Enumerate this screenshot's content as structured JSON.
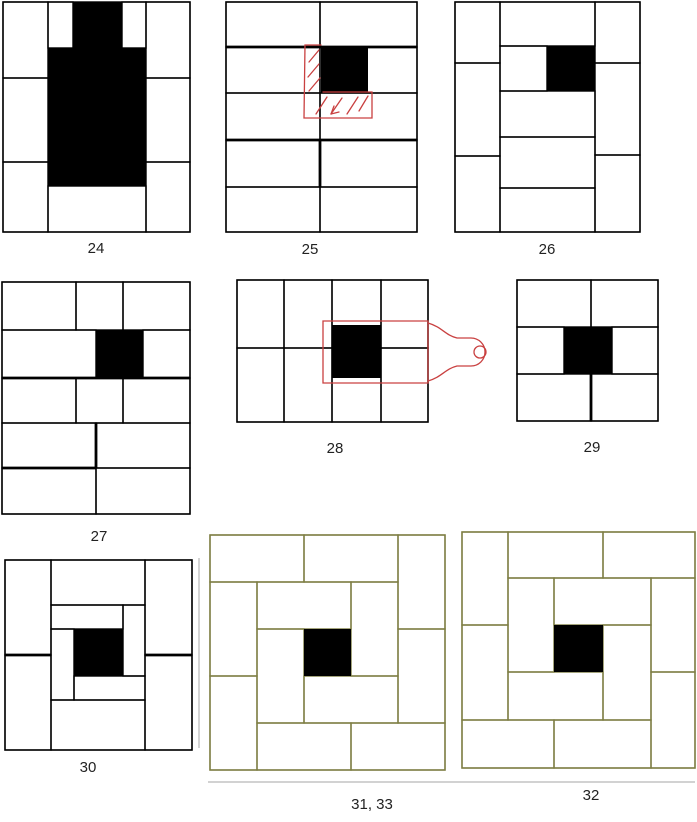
{
  "canvas": {
    "width": 697,
    "height": 822,
    "background": "#ffffff"
  },
  "colors": {
    "line": "#000000",
    "olive": "#7e7e44",
    "red": "#c94040",
    "artifact_gray": "#b8b8b8",
    "black_fill": "#000000",
    "caption_text": "#222222"
  },
  "diagrams": [
    {
      "id": "24",
      "caption": "24",
      "stroke": "#000000",
      "frame": [
        3,
        2,
        187,
        230
      ],
      "cells": [
        [
          3,
          2,
          45,
          76
        ],
        [
          3,
          78,
          45,
          84
        ],
        [
          3,
          162,
          45,
          70
        ],
        [
          146,
          2,
          44,
          76
        ],
        [
          146,
          78,
          44,
          84
        ],
        [
          146,
          162,
          44,
          70
        ],
        [
          48,
          2,
          25,
          46
        ],
        [
          122,
          2,
          24,
          46
        ],
        [
          48,
          186,
          98,
          46
        ]
      ],
      "black": [
        [
          73,
          2,
          49,
          46
        ],
        [
          48,
          48,
          98,
          138
        ]
      ]
    },
    {
      "id": "25",
      "caption": "25",
      "stroke": "#000000",
      "frame": [
        226,
        2,
        191,
        230
      ],
      "cells": [
        [
          226,
          2,
          94,
          45
        ],
        [
          320,
          2,
          97,
          45
        ],
        [
          226,
          47,
          94,
          46
        ],
        [
          320,
          47,
          97,
          46
        ],
        [
          226,
          93,
          94,
          47
        ],
        [
          320,
          93,
          97,
          47
        ],
        [
          226,
          140,
          94,
          47
        ],
        [
          320,
          140,
          97,
          47
        ],
        [
          226,
          187,
          94,
          45
        ],
        [
          320,
          187,
          97,
          45
        ]
      ],
      "bold": [
        [
          226,
          47,
          417,
          47
        ],
        [
          226,
          140,
          417,
          140
        ],
        [
          320,
          140,
          320,
          187
        ]
      ],
      "black": [
        [
          321,
          47,
          47,
          46
        ]
      ],
      "red_paths": [
        "M321,45 L305,45 L304,118 L372,118 L372,92 L323,92",
        "M309,62 L319,50",
        "M308,77 L319,64",
        "M309,91 L320,78",
        "M316,114 L327,97",
        "M331,114 L342,98",
        "M347,114 L358,97",
        "M359,111 L368,96",
        "M331,114 L334,106",
        "M331,114 L339,112"
      ]
    },
    {
      "id": "26",
      "caption": "26",
      "stroke": "#000000",
      "frame": [
        455,
        2,
        185,
        230
      ],
      "cells": [
        [
          455,
          2,
          45,
          61
        ],
        [
          455,
          63,
          45,
          93
        ],
        [
          455,
          156,
          45,
          76
        ],
        [
          595,
          2,
          45,
          61
        ],
        [
          595,
          63,
          45,
          92
        ],
        [
          595,
          155,
          45,
          77
        ],
        [
          500,
          2,
          95,
          44
        ],
        [
          500,
          46,
          47,
          45
        ],
        [
          500,
          91,
          95,
          46
        ],
        [
          500,
          137,
          95,
          51
        ],
        [
          500,
          188,
          95,
          44
        ]
      ],
      "black": [
        [
          547,
          46,
          48,
          45
        ]
      ]
    },
    {
      "id": "27",
      "caption": "27",
      "stroke": "#000000",
      "frame": [
        2,
        282,
        188,
        232
      ],
      "cells": [
        [
          2,
          282,
          74,
          48
        ],
        [
          76,
          282,
          47,
          48
        ],
        [
          123,
          282,
          67,
          48
        ],
        [
          2,
          330,
          94,
          48
        ],
        [
          143,
          330,
          47,
          48
        ],
        [
          2,
          378,
          74,
          45
        ],
        [
          76,
          378,
          47,
          45
        ],
        [
          123,
          378,
          67,
          45
        ],
        [
          2,
          423,
          94,
          45
        ],
        [
          96,
          423,
          94,
          45
        ],
        [
          2,
          468,
          94,
          46
        ],
        [
          96,
          468,
          94,
          46
        ]
      ],
      "bold": [
        [
          2,
          378,
          190,
          378
        ],
        [
          2,
          468,
          96,
          468
        ],
        [
          96,
          423,
          96,
          468
        ]
      ],
      "black": [
        [
          96,
          330,
          47,
          48
        ]
      ]
    },
    {
      "id": "28",
      "caption": "28",
      "stroke": "#000000",
      "frame": [
        237,
        280,
        191,
        142
      ],
      "cells": [
        [
          237,
          280,
          47,
          68
        ],
        [
          284,
          280,
          48,
          68
        ],
        [
          332,
          280,
          49,
          68
        ],
        [
          381,
          280,
          47,
          68
        ],
        [
          237,
          348,
          47,
          74
        ],
        [
          284,
          348,
          48,
          74
        ],
        [
          332,
          348,
          49,
          74
        ],
        [
          381,
          348,
          47,
          74
        ]
      ],
      "black": [
        [
          332,
          325,
          49,
          53
        ]
      ],
      "red_paths": [
        "M323,321 L428,321 L428,383 L323,383 Z",
        "M428,323 C442,327 445,335 457,338 L471,338 A14,14 0 1 1 471,366 L457,366 C445,369 442,377 428,381",
        "M486,352 a6,6 0 1 1 -12,0 a6,6 0 1 1 12,0"
      ]
    },
    {
      "id": "29",
      "caption": "29",
      "stroke": "#000000",
      "frame": [
        517,
        280,
        141,
        141
      ],
      "cells": [
        [
          517,
          280,
          74,
          47
        ],
        [
          591,
          280,
          67,
          47
        ],
        [
          517,
          327,
          47,
          47
        ],
        [
          612,
          327,
          46,
          47
        ],
        [
          517,
          374,
          74,
          47
        ],
        [
          591,
          374,
          67,
          47
        ]
      ],
      "bold": [
        [
          591,
          374,
          591,
          421
        ]
      ],
      "black": [
        [
          564,
          327,
          48,
          47
        ]
      ]
    },
    {
      "id": "30",
      "caption": "30",
      "stroke": "#000000",
      "frame": [
        5,
        560,
        187,
        190
      ],
      "cells": [
        [
          5,
          560,
          46,
          95
        ],
        [
          5,
          655,
          46,
          95
        ],
        [
          145,
          560,
          47,
          95
        ],
        [
          145,
          655,
          47,
          95
        ],
        [
          51,
          560,
          94,
          45
        ],
        [
          51,
          700,
          94,
          50
        ],
        [
          51,
          605,
          72,
          24
        ],
        [
          123,
          605,
          22,
          71
        ],
        [
          51,
          629,
          23,
          71
        ],
        [
          74,
          676,
          71,
          24
        ]
      ],
      "bold": [
        [
          5,
          655,
          51,
          655
        ],
        [
          145,
          655,
          192,
          655
        ]
      ],
      "black": [
        [
          74,
          629,
          49,
          47
        ]
      ]
    },
    {
      "id": "31-33",
      "caption": "31, 33",
      "stroke": "#7e7e44",
      "frame": [
        210,
        535,
        235,
        235
      ],
      "cells": [
        [
          210,
          535,
          94,
          47
        ],
        [
          304,
          535,
          94,
          47
        ],
        [
          398,
          535,
          47,
          94
        ],
        [
          398,
          629,
          47,
          94
        ],
        [
          351,
          723,
          94,
          47
        ],
        [
          257,
          723,
          94,
          47
        ],
        [
          210,
          676,
          47,
          94
        ],
        [
          210,
          582,
          47,
          94
        ],
        [
          257,
          582,
          94,
          47
        ],
        [
          351,
          582,
          47,
          94
        ],
        [
          304,
          676,
          94,
          47
        ],
        [
          257,
          629,
          47,
          94
        ]
      ],
      "black": [
        [
          304,
          629,
          47,
          47
        ]
      ]
    },
    {
      "id": "32",
      "caption": "32",
      "stroke": "#7e7e44",
      "frame": [
        462,
        532,
        233,
        236
      ],
      "cells": [
        [
          462,
          532,
          46,
          93
        ],
        [
          508,
          532,
          95,
          46
        ],
        [
          603,
          532,
          92,
          46
        ],
        [
          651,
          578,
          44,
          94
        ],
        [
          651,
          672,
          44,
          96
        ],
        [
          554,
          720,
          97,
          48
        ],
        [
          462,
          720,
          92,
          48
        ],
        [
          462,
          625,
          46,
          95
        ],
        [
          554,
          578,
          97,
          47
        ],
        [
          508,
          578,
          46,
          94
        ],
        [
          508,
          672,
          95,
          48
        ],
        [
          603,
          625,
          48,
          95
        ]
      ],
      "black": [
        [
          554,
          625,
          49,
          47
        ]
      ]
    },
    {
      "id": "artifacts",
      "stroke": "#b8b8b8",
      "lines": [
        [
          199,
          558,
          199,
          748
        ],
        [
          208,
          782,
          695,
          782
        ]
      ]
    }
  ]
}
